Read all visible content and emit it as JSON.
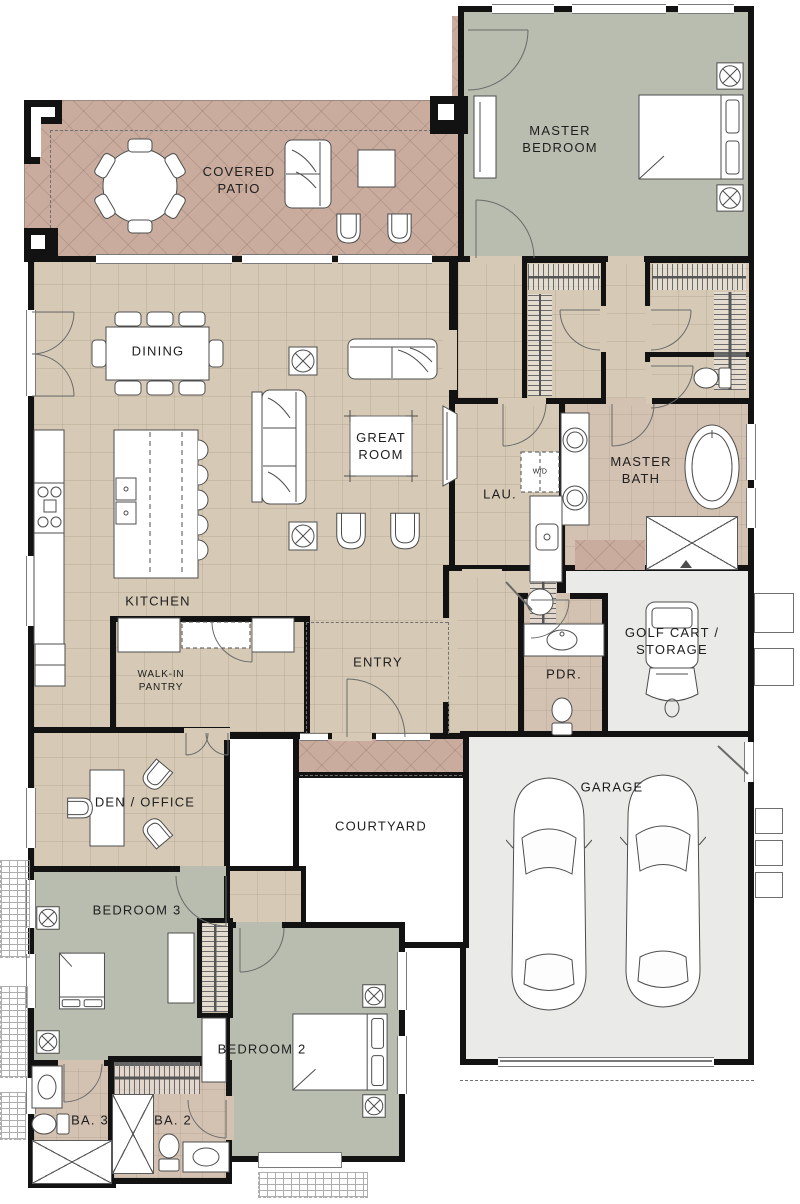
{
  "plan": {
    "type": "residential-floor-plan",
    "rooms": {
      "covered_patio": {
        "label": "COVERED\nPATIO"
      },
      "master_bedroom": {
        "label": "MASTER\nBEDROOM"
      },
      "dining": {
        "label": "DINING"
      },
      "great_room": {
        "label": "GREAT\nROOM"
      },
      "master_bath": {
        "label": "MASTER\nBATH"
      },
      "laundry": {
        "label": "LAU."
      },
      "washer_dryer": {
        "label": "W/D"
      },
      "kitchen": {
        "label": "KITCHEN"
      },
      "walk_in_pantry": {
        "label": "WALK-IN\nPANTRY"
      },
      "entry": {
        "label": "ENTRY"
      },
      "powder": {
        "label": "PDR."
      },
      "golf_cart_storage": {
        "label": "GOLF CART /\nSTORAGE"
      },
      "garage": {
        "label": "GARAGE"
      },
      "den_office": {
        "label": "DEN / OFFICE"
      },
      "courtyard": {
        "label": "COURTYARD"
      },
      "bedroom_3": {
        "label": "BEDROOM 3"
      },
      "bedroom_2": {
        "label": "BEDROOM 2"
      },
      "bath_3": {
        "label": "BA. 3"
      },
      "bath_2": {
        "label": "BA. 2"
      }
    },
    "colors": {
      "wall": "#121212",
      "patio_floor": "#c9ac9e",
      "interior_floor": "#d6cab6",
      "bedroom_floor": "#b8bdaf",
      "bath_floor": "#d3c1b2",
      "garage_floor": "#eaeae8",
      "courtyard_floor": "#ffffff",
      "furniture_line": "#4d4d4d"
    }
  }
}
